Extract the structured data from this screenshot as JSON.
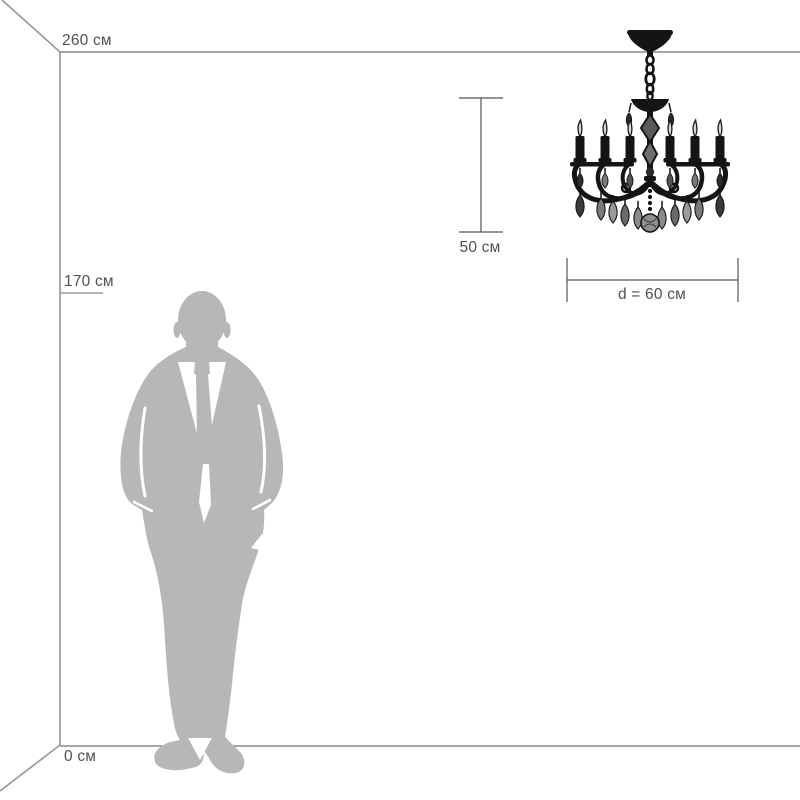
{
  "diagram": {
    "title_hint": "chandelier size diagram with human figure for scale",
    "labels": {
      "ceiling_height": "260 см",
      "person_height": "170 см",
      "floor": "0 см",
      "fixture_height": "50 см",
      "fixture_diameter": "d = 60 см"
    },
    "icons": {
      "man": "man-silhouette",
      "chandelier": "chandelier-silhouette"
    },
    "colors": {
      "text_gray": "#4e5052",
      "line_gray": "#9a9a9a",
      "ruler_gray": "#555555",
      "silhouette_gray": "#b5b7b9",
      "fixture_black": "#141414",
      "background": "#ffffff"
    }
  }
}
